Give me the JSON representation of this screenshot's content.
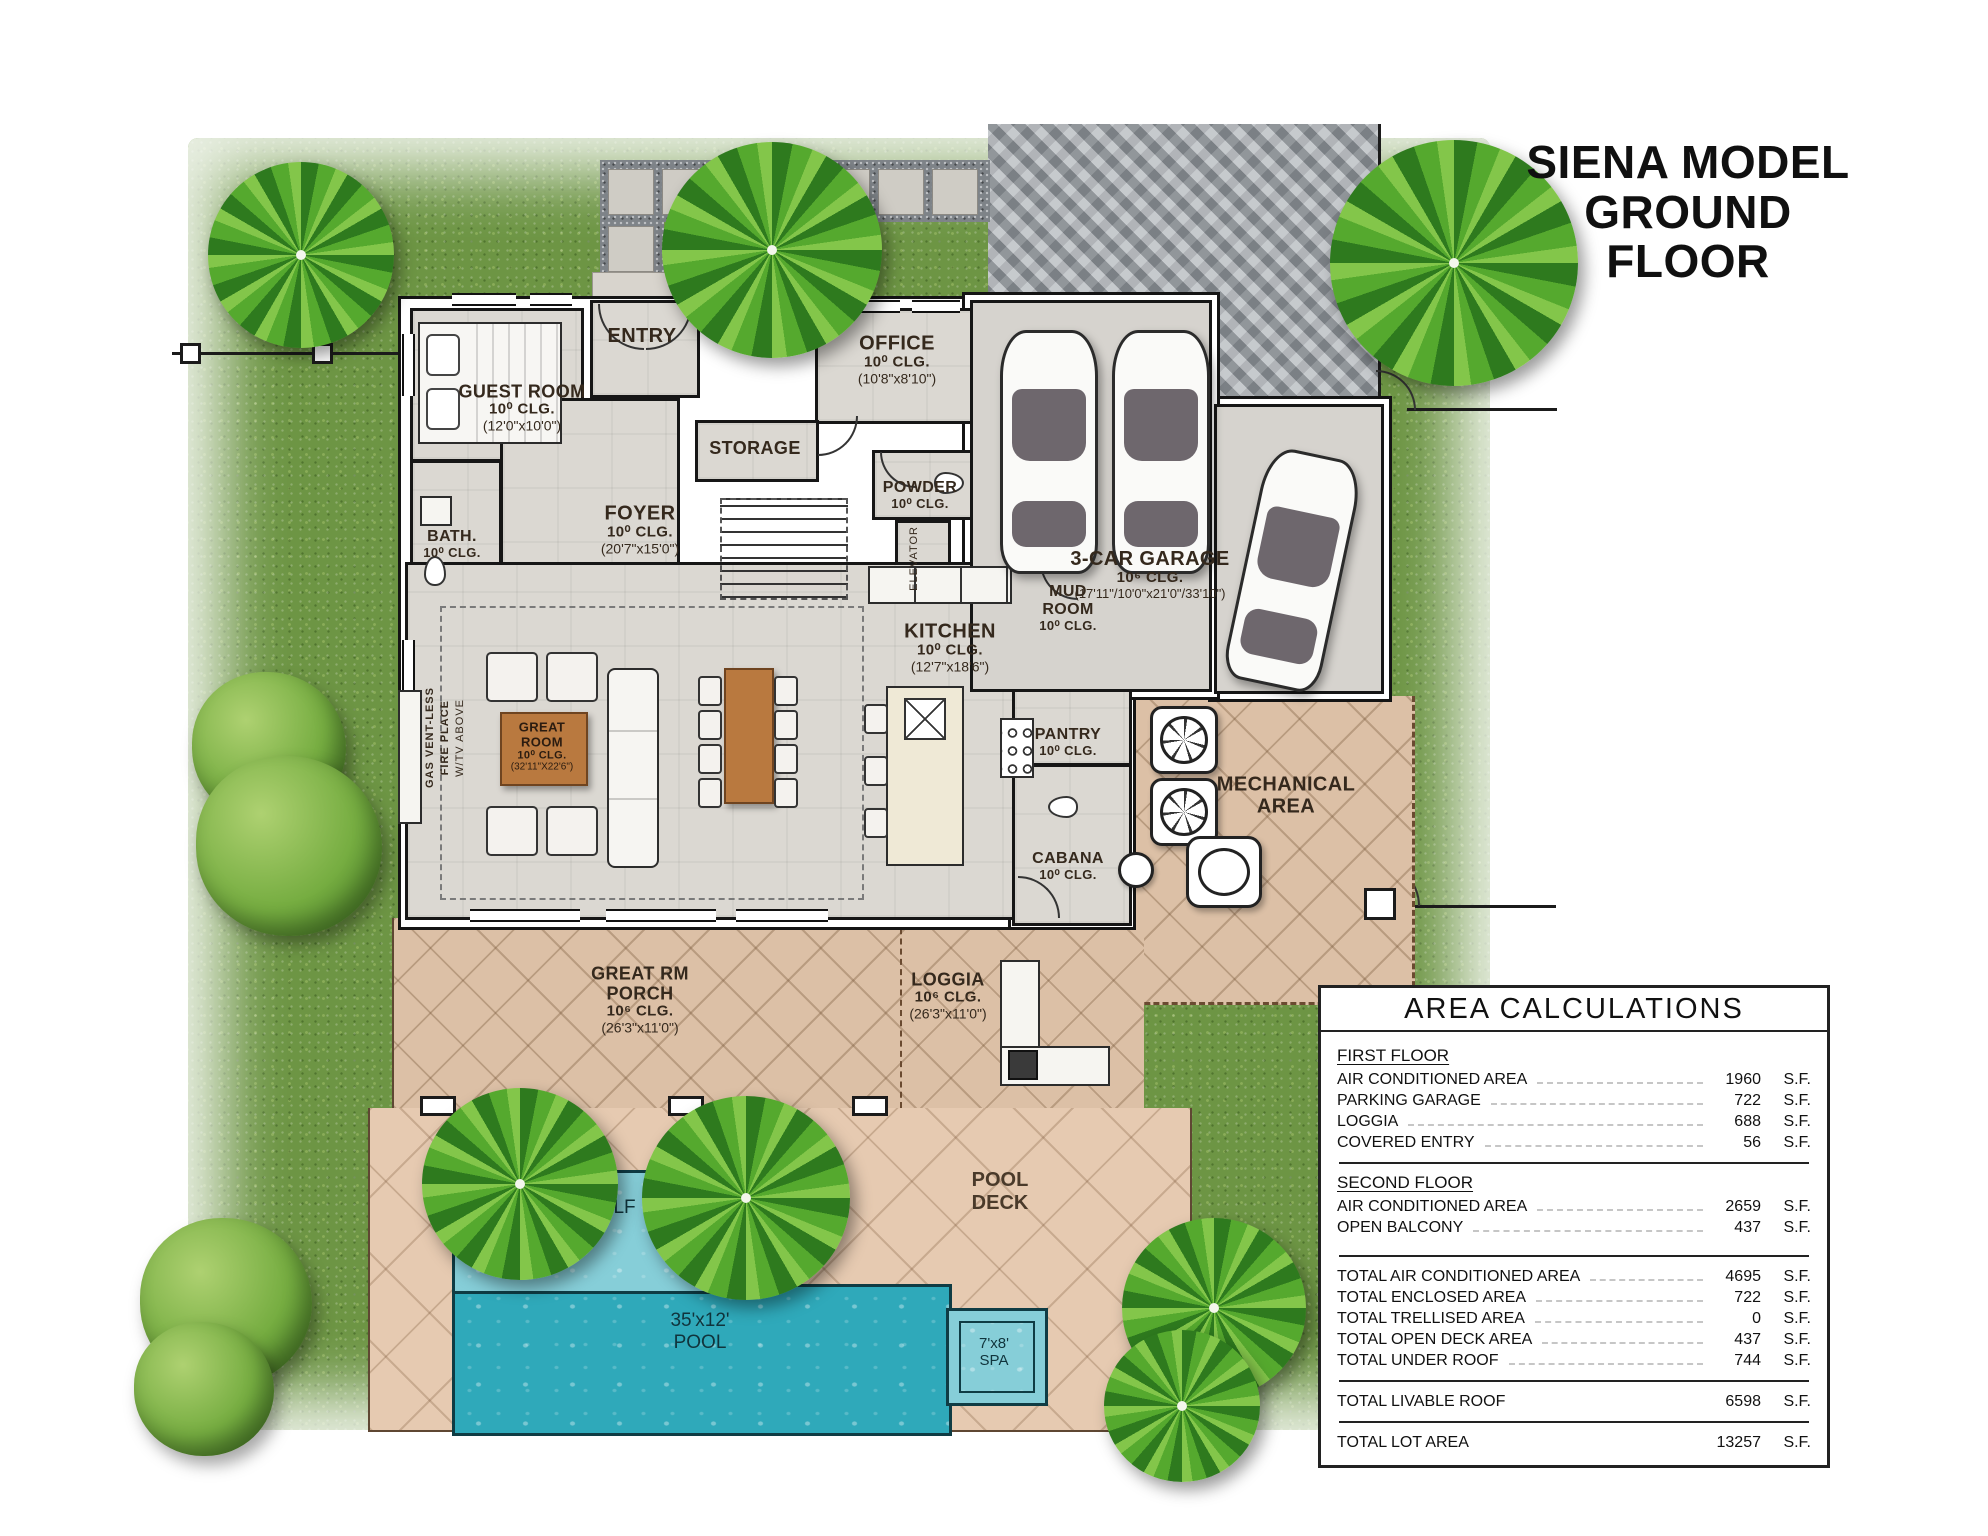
{
  "title": {
    "line1": "SIENA MODEL",
    "line2": "GROUND FLOOR"
  },
  "rooms": {
    "entry": {
      "name": "ENTRY"
    },
    "guest": {
      "name": "GUEST ROOM",
      "clg": "10⁰ CLG.",
      "dims": "(12'0\"x10'0\")"
    },
    "bath": {
      "name": "BATH.",
      "clg": "10⁰ CLG."
    },
    "office": {
      "name": "OFFICE",
      "clg": "10⁰ CLG.",
      "dims": "(10'8\"x8'10\")"
    },
    "storage": {
      "name": "STORAGE"
    },
    "powder": {
      "name": "POWDER",
      "clg": "10⁰ CLG."
    },
    "foyer": {
      "name": "FOYER",
      "clg": "10⁰ CLG.",
      "dims": "(20'7\"x15'0\")"
    },
    "elevator": {
      "name": "ELEVATOR"
    },
    "kitchen": {
      "name": "KITCHEN",
      "clg": "10⁰ CLG.",
      "dims": "(12'7\"x18'6\")"
    },
    "mud": {
      "name": "MUD ROOM",
      "clg": "10⁰ CLG."
    },
    "pantry": {
      "name": "PANTRY",
      "clg": "10⁰ CLG."
    },
    "garage": {
      "name": "3-CAR GARAGE",
      "clg": "10⁶ CLG.",
      "dims": "(17'11\"/10'0\"x21'0\"/33'10\")"
    },
    "great": {
      "name": "GREAT ROOM",
      "clg": "10⁰ CLG.",
      "dims": "(32'11\"X22'6\")"
    },
    "cabana": {
      "name": "CABANA",
      "clg": "10⁰ CLG."
    },
    "mechanical": {
      "name": "MECHANICAL AREA"
    },
    "porch": {
      "name": "GREAT RM PORCH",
      "clg": "10⁶ CLG.",
      "dims": "(26'3\"x11'0\")"
    },
    "loggia": {
      "name": "LOGGIA",
      "clg": "10⁶ CLG.",
      "dims": "(26'3\"x11'0\")"
    },
    "pool_deck": {
      "name": "POOL DECK"
    },
    "sunshelf": {
      "name": "SUNSHELF"
    },
    "pool": {
      "size": "35'x12'",
      "name": "POOL"
    },
    "spa": {
      "size": "7'x8'",
      "name": "SPA"
    }
  },
  "fireplace": {
    "l1": "GAS VENT-LESS",
    "l2": "FIRE PLACE",
    "l3": "W/TV ABOVE"
  },
  "area_table": {
    "title": "AREA CALCULATIONS",
    "groups": [
      {
        "heading": "FIRST FLOOR",
        "rows": [
          {
            "label": "AIR CONDITIONED AREA",
            "value": "1960",
            "unit": "S.F."
          },
          {
            "label": "PARKING GARAGE",
            "value": "722",
            "unit": "S.F."
          },
          {
            "label": "LOGGIA",
            "value": "688",
            "unit": "S.F."
          },
          {
            "label": "COVERED ENTRY",
            "value": "56",
            "unit": "S.F."
          }
        ]
      },
      {
        "heading": "SECOND FLOOR",
        "rows": [
          {
            "label": "AIR CONDITIONED AREA",
            "value": "2659",
            "unit": "S.F."
          },
          {
            "label": "OPEN BALCONY",
            "value": "437",
            "unit": "S.F."
          }
        ]
      },
      {
        "rows": [
          {
            "label": "TOTAL AIR CONDITIONED AREA",
            "value": "4695",
            "unit": "S.F."
          },
          {
            "label": "TOTAL ENCLOSED AREA",
            "value": "722",
            "unit": "S.F."
          },
          {
            "label": "TOTAL TRELLISED AREA",
            "value": "0",
            "unit": "S.F."
          },
          {
            "label": "TOTAL OPEN DECK AREA",
            "value": "437",
            "unit": "S.F."
          },
          {
            "label": "TOTAL UNDER ROOF",
            "value": "744",
            "unit": "S.F."
          }
        ]
      },
      {
        "rows": [
          {
            "label": "TOTAL LIVABLE ROOF",
            "value": "6598",
            "unit": "S.F."
          }
        ]
      },
      {
        "rows": [
          {
            "label": "TOTAL LOT AREA",
            "value": "13257",
            "unit": "S.F."
          }
        ]
      }
    ]
  },
  "colors": {
    "grass": "#6d9544",
    "driveway": "#a3a8ad",
    "patio_tile": "#dcc0a6",
    "pool_deck": "#e6cab1",
    "pool_water": "#2fa9ba",
    "sunshelf_water": "#86ced8",
    "interior_floor": "#dbd8d2",
    "label_text": "#35291d",
    "wood_table": "#b9793f"
  }
}
